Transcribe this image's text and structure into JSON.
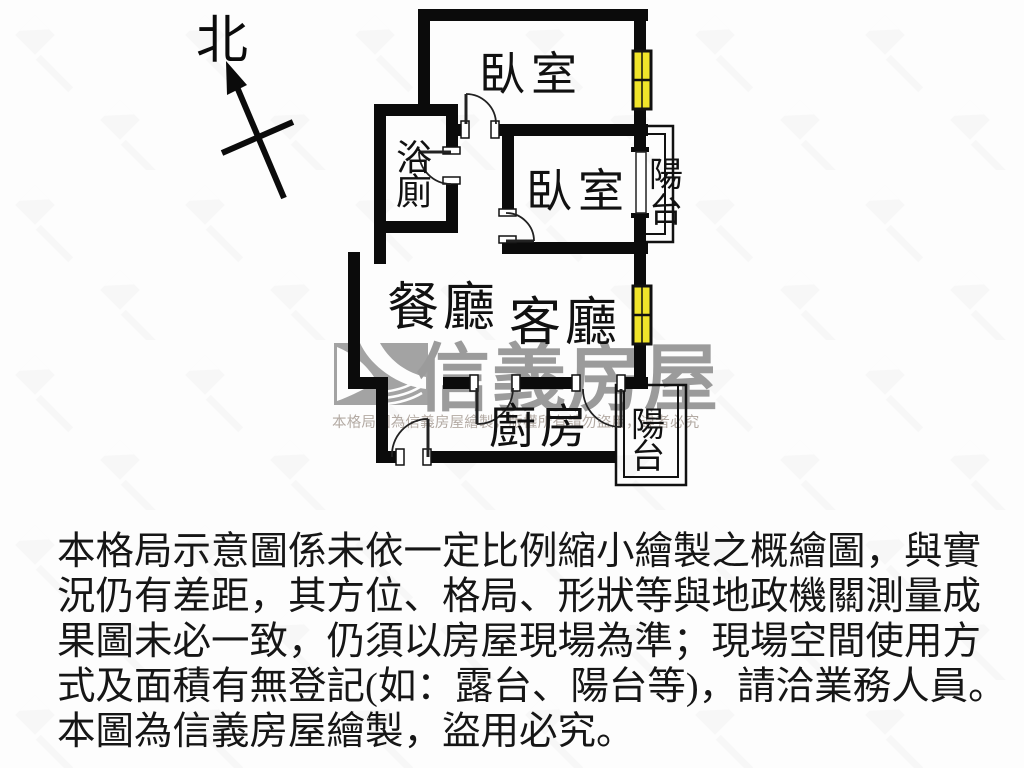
{
  "compass": {
    "label": "北"
  },
  "plan": {
    "labels": {
      "bedroom1": "臥室",
      "bedroom2": "臥室",
      "bathroom": [
        "浴",
        "廁"
      ],
      "dining": "餐廳",
      "living": "客廳",
      "kitchen": "廚房",
      "balcony_right": [
        "陽",
        "台"
      ],
      "balcony_bottom": [
        "陽",
        "台"
      ]
    },
    "colors": {
      "wall": "#0b0b0b",
      "wall_glow": "#f6f0b4",
      "window_yellow": "#f0e42a",
      "window_frame": "#111111"
    }
  },
  "watermark": {
    "brand": "信義房屋",
    "notice": "本格局圖為信義房屋繪製，版權所有請勿盜用，違者必究",
    "logo_color": "#a3a3a3",
    "brand_color": "#9b9b9b",
    "notice_color": "#b3aaa3"
  },
  "disclaimer": {
    "lines": [
      "本格局示意圖係未依一定比例縮小繪製之概繪圖，與實",
      "況仍有差距，其方位、格局、形狀等與地政機關測量成",
      "果圖未必一致，仍須以房屋現場為準；現場空間使用方",
      "式及面積有無登記(如：露台、陽台等)，請洽業務人員。",
      "本圖為信義房屋繪製，盜用必究。"
    ]
  }
}
